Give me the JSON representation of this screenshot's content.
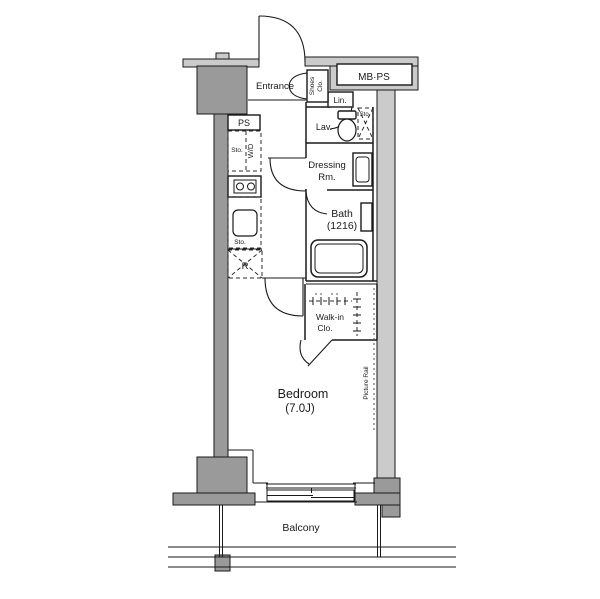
{
  "plan": {
    "type": "apartment-floor-plan",
    "colors": {
      "wall_dark": "#9a9a9a",
      "wall_light": "#cbcbcb",
      "line": "#1a1a1a",
      "background": "#ffffff"
    },
    "rooms": {
      "entrance": {
        "label": "Entrance"
      },
      "shoes_closet": {
        "line1": "Shoes",
        "line2": "Clo."
      },
      "mb_ps": {
        "label": "MB·PS"
      },
      "linen": {
        "label": "Lin."
      },
      "lavatory": {
        "label": "Lav."
      },
      "storage_upper_right": {
        "label": "Sto."
      },
      "ps_shaft": {
        "label": "PS"
      },
      "storage_kitchen": {
        "label": "Sto."
      },
      "washer_dryer": {
        "label": "W/D"
      },
      "storage_sink": {
        "label": "Sto."
      },
      "refrigerator": {
        "label": "R"
      },
      "dressing_room": {
        "line1": "Dressing",
        "line2": "Rm."
      },
      "bath": {
        "line1": "Bath",
        "line2": "(1216)"
      },
      "walk_in_closet": {
        "line1": "Walk-in",
        "line2": "Clo."
      },
      "bedroom": {
        "line1": "Bedroom",
        "line2": "(7.0J)"
      },
      "picture_rail": {
        "label": "Picture Rail"
      },
      "balcony": {
        "label": "Balcony"
      }
    }
  }
}
